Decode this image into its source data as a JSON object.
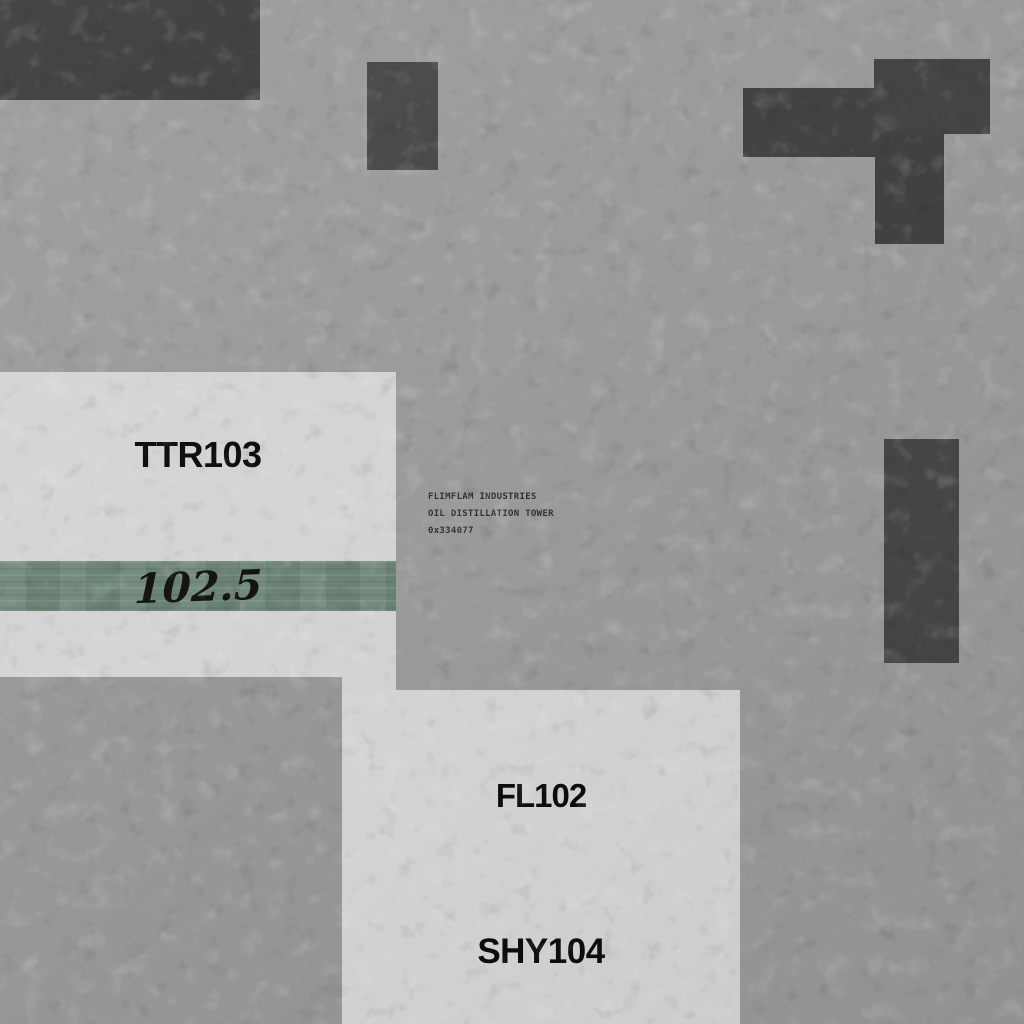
{
  "scene": {
    "colors": {
      "floor_background": "#9b9b9b",
      "floor_panel_light": "#d5d5d5",
      "floor_region_lower_left": "#989898",
      "structure_dark": "#434343",
      "band_green": "#6e8778",
      "zone_label_text": "#0d0d0d",
      "tooltip_text": "#2e2e2e"
    },
    "zones": {
      "ttr103": {
        "label": "TTR103"
      },
      "band": {
        "value": "102.5"
      },
      "fl102": {
        "label": "FL102"
      },
      "shy104": {
        "label": "SHY104"
      }
    },
    "tooltip": {
      "company": "FLIMFLAM INDUSTRIES",
      "entity": "OIL DISTILLATION TOWER",
      "id": "0x334077"
    }
  }
}
